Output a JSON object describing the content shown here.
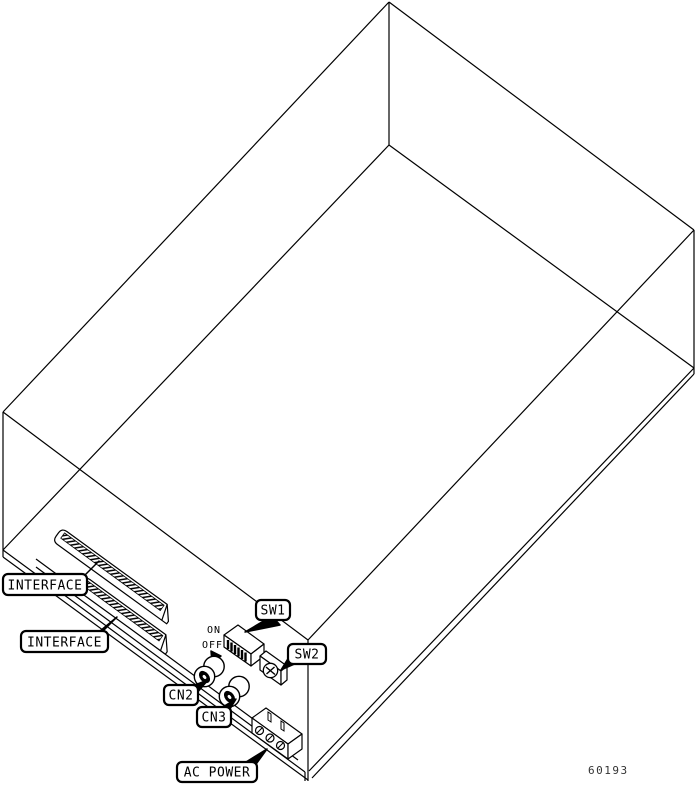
{
  "figure": {
    "number": "60193"
  },
  "callouts": {
    "interface1": {
      "label": "INTERFACE"
    },
    "interface2": {
      "label": "INTERFACE"
    },
    "sw1": {
      "label": "SW1"
    },
    "sw2": {
      "label": "SW2"
    },
    "cn2": {
      "label": "CN2"
    },
    "cn3": {
      "label": "CN3"
    },
    "ac_power": {
      "label": "AC POWER"
    }
  },
  "dip_switch": {
    "on_label": "ON",
    "off_label": "OFF",
    "positions": 6
  },
  "colors": {
    "line": "#000000",
    "background": "#ffffff",
    "figure_number": "#333333"
  }
}
